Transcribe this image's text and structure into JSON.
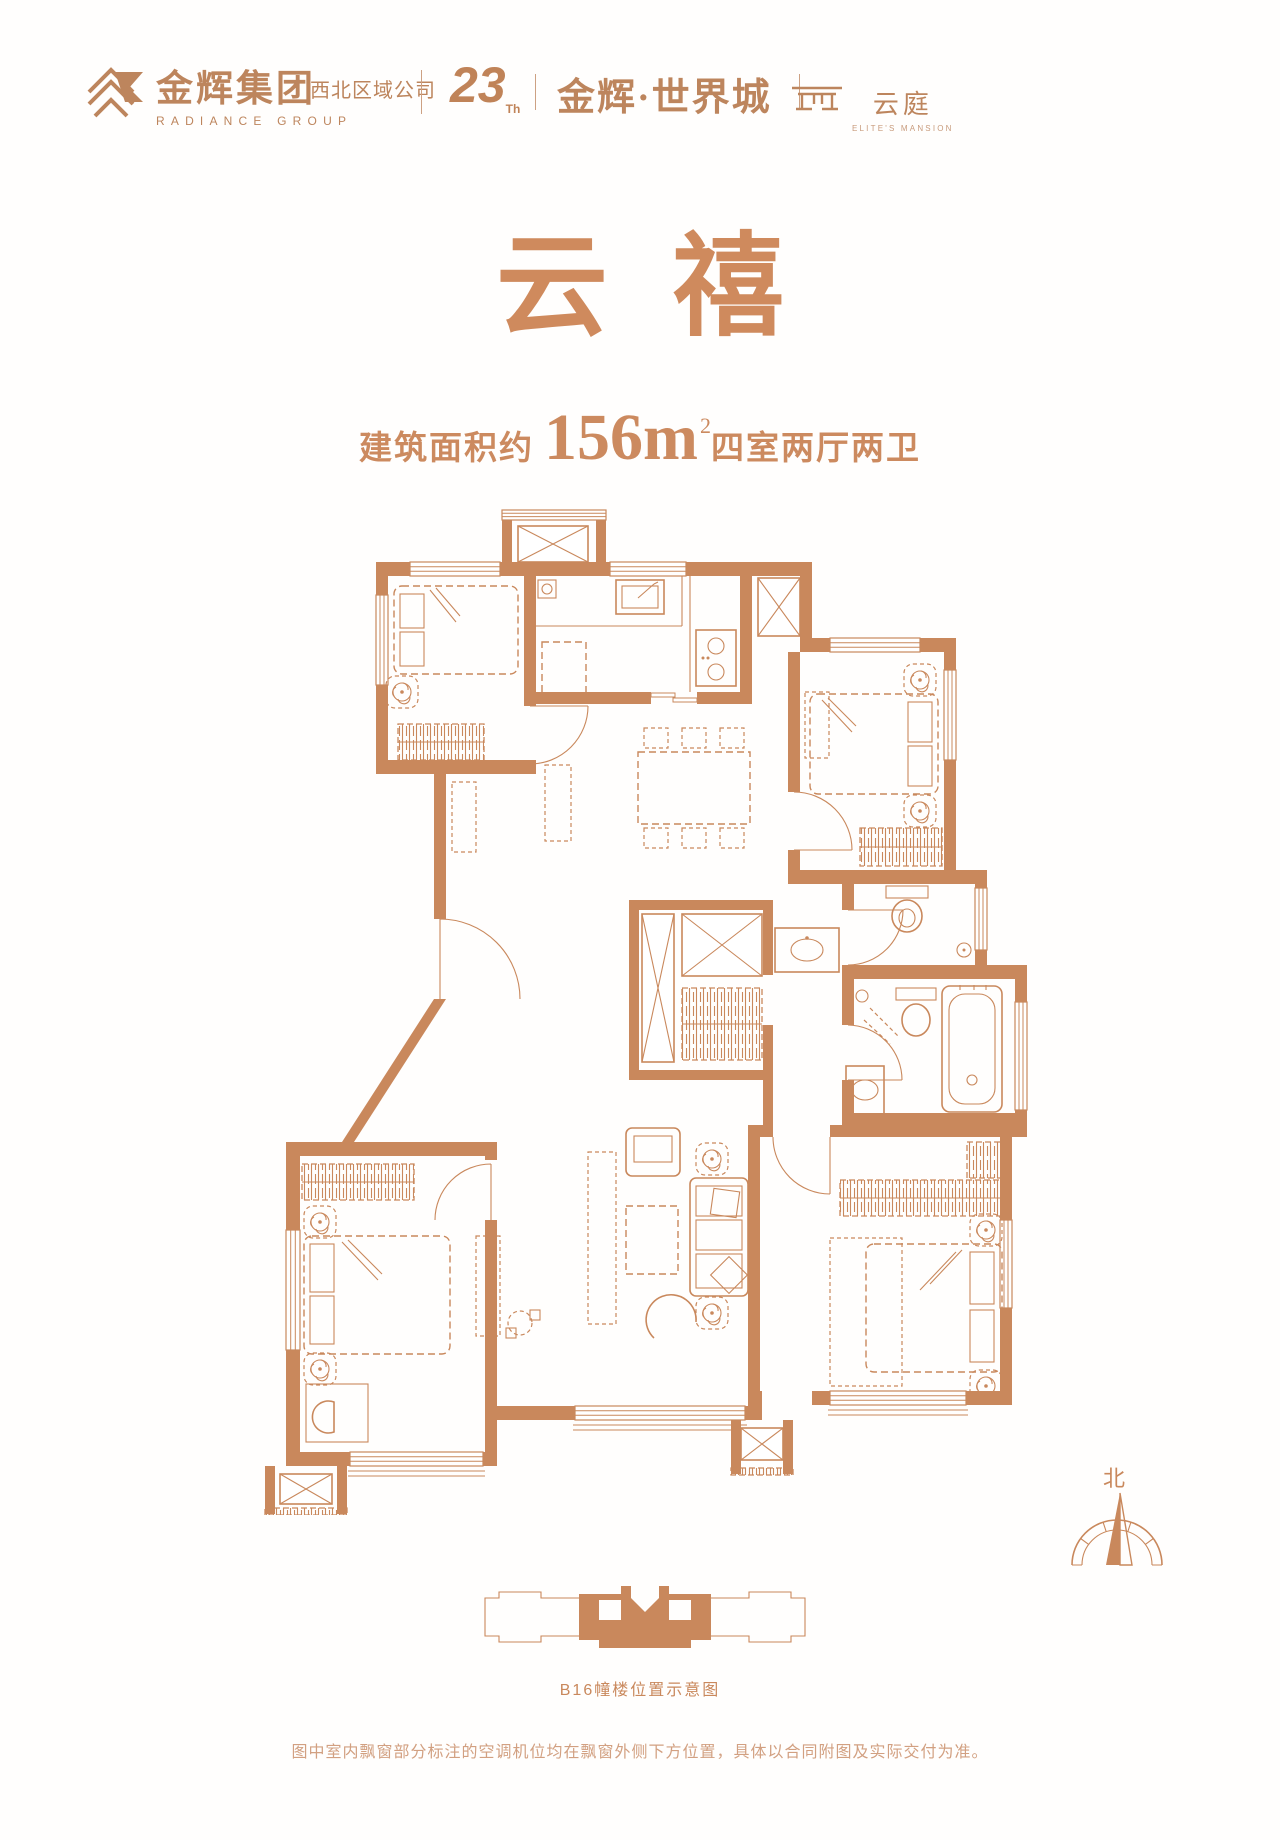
{
  "colors": {
    "accent": "#C9885C",
    "title": "#CF8A5D",
    "brand": "#BD855D",
    "footer_text": "#D2A081",
    "background": "#FFFEFD"
  },
  "header": {
    "brand_cn": "金辉集团",
    "brand_en": "RADIANCE GROUP",
    "brand_region": "西北区域公司",
    "anniversary_number": "23",
    "anniversary_suffix": "Th",
    "project_name": "金辉·世界城",
    "sub_brand_cn": "云庭",
    "sub_brand_en": "ELITE'S MANSION"
  },
  "hero": {
    "unit_name": "云禧",
    "area_prefix": "建筑面积约",
    "area_number": "156m",
    "area_sup": "2",
    "unit_layout": "四室两厅两卫"
  },
  "plan": {
    "compass_label": "北",
    "location_caption": "B16幢楼位置示意图"
  },
  "footer": {
    "disclaimer": "图中室内飘窗部分标注的空调机位均在飘窗外侧下方位置，具体以合同附图及实际交付为准。"
  }
}
